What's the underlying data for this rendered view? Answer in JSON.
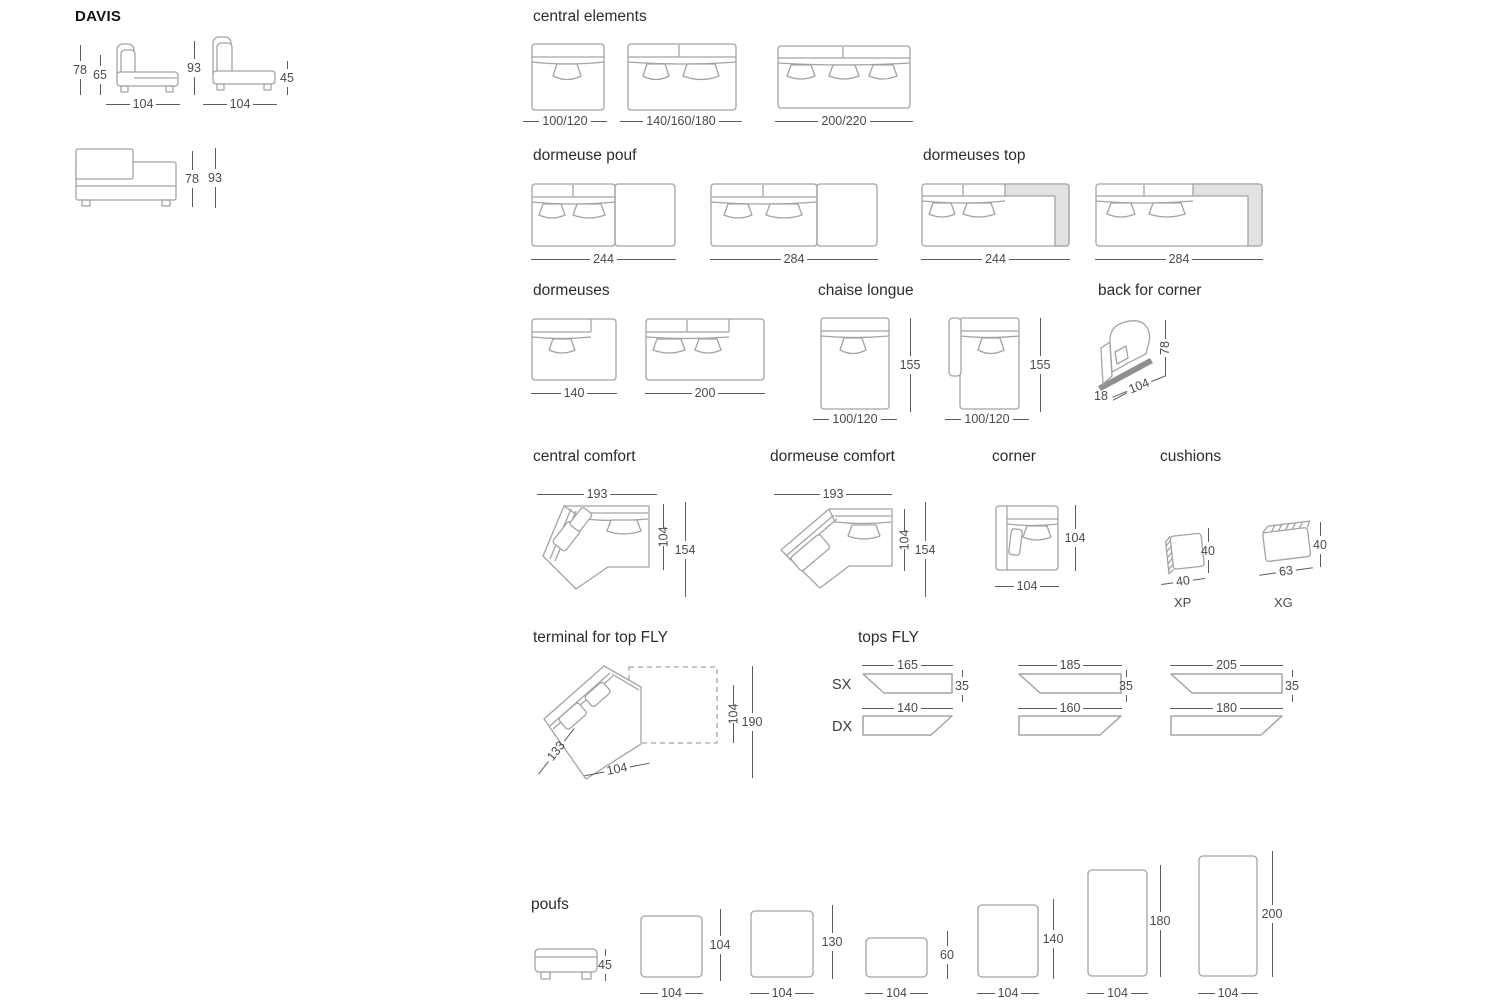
{
  "title": "DAVIS",
  "colors": {
    "outline": "#a3a3a3",
    "dimension_text": "#4a4a4a",
    "top_fill_gray": "#e2e2e2"
  },
  "overview": {
    "side_element": {
      "back_height": "78",
      "back_cushion_height": "65",
      "width": "104"
    },
    "side_element_high": {
      "back_height": "93",
      "seat_height": "45",
      "width": "104"
    },
    "front_element": {
      "back_height": "78",
      "total_height": "93"
    }
  },
  "central_elements": {
    "title": "central elements",
    "items": [
      {
        "width": "100/120"
      },
      {
        "width": "140/160/180"
      },
      {
        "width": "200/220"
      }
    ]
  },
  "dormeuse_pouf": {
    "title": "dormeuse pouf",
    "items": [
      {
        "width": "244"
      },
      {
        "width": "284"
      }
    ]
  },
  "dormeuses_top": {
    "title": "dormeuses top",
    "items": [
      {
        "width": "244"
      },
      {
        "width": "284"
      }
    ]
  },
  "dormeuses": {
    "title": "dormeuses",
    "items": [
      {
        "width": "140"
      },
      {
        "width": "200"
      }
    ]
  },
  "chaise_longue": {
    "title": "chaise longue",
    "items": [
      {
        "width": "100/120",
        "depth": "155"
      },
      {
        "width": "100/120",
        "depth": "155"
      }
    ]
  },
  "back_for_corner": {
    "title": "back for corner",
    "thickness": "18",
    "width": "104",
    "height": "78"
  },
  "central_comfort": {
    "title": "central comfort",
    "width": "193",
    "seat_depth": "104",
    "total_depth": "154"
  },
  "dormeuse_comfort": {
    "title": "dormeuse comfort",
    "width": "193",
    "seat_depth": "104",
    "total_depth": "154"
  },
  "corner": {
    "title": "corner",
    "width": "104",
    "depth": "104"
  },
  "cushions": {
    "title": "cushions",
    "items": [
      {
        "code": "XP",
        "width": "40",
        "height": "40"
      },
      {
        "code": "XG",
        "width": "63",
        "height": "40"
      }
    ]
  },
  "terminal_top_fly": {
    "title": "terminal for top FLY",
    "side_width": "133",
    "width": "104",
    "top_depth": "104",
    "total_depth": "190"
  },
  "tops_fly": {
    "title": "tops FLY",
    "sx_label": "SX",
    "dx_label": "DX",
    "items": [
      {
        "sx_width": "165",
        "dx_width": "140",
        "height": "35"
      },
      {
        "sx_width": "185",
        "dx_width": "160",
        "height": "35"
      },
      {
        "sx_width": "205",
        "dx_width": "180",
        "height": "35"
      }
    ]
  },
  "poufs": {
    "title": "poufs",
    "side_height": "45",
    "items": [
      {
        "width": "104",
        "depth": "104"
      },
      {
        "width": "104",
        "depth": "130"
      },
      {
        "width": "104",
        "depth": "60"
      },
      {
        "width": "104",
        "depth": "140"
      },
      {
        "width": "104",
        "depth": "180"
      },
      {
        "width": "104",
        "depth": "200"
      }
    ]
  }
}
